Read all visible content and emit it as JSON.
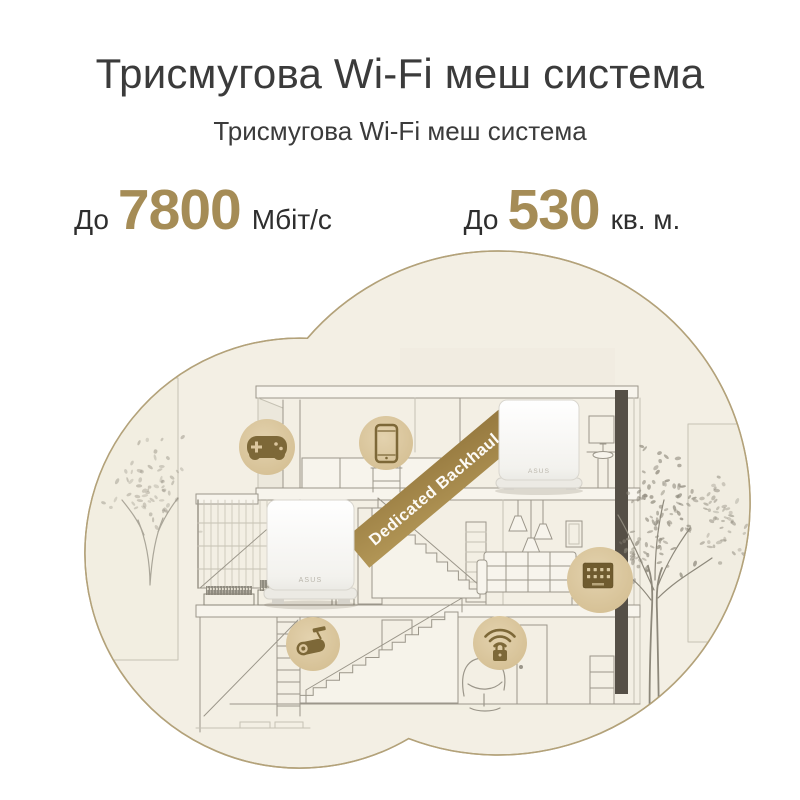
{
  "header": {
    "title": "Трисмугова Wi-Fi меш система",
    "subtitle": "Трисмугова Wi-Fi меш система"
  },
  "specs": [
    {
      "prefix": "До",
      "value": "7800",
      "unit": "Мбіт/с"
    },
    {
      "prefix": "До",
      "value": "530",
      "unit": "кв. м."
    }
  ],
  "diagram": {
    "ribbon_label": "Dedicated Backhaul",
    "router_brand": "ASUS",
    "icons": [
      {
        "name": "gamepad-icon",
        "meaning": "gaming device"
      },
      {
        "name": "smartphone-icon",
        "meaning": "mobile device"
      },
      {
        "name": "security-camera-icon",
        "meaning": "surveillance camera"
      },
      {
        "name": "secured-wifi-icon",
        "meaning": "protected wifi network"
      },
      {
        "name": "smart-panel-icon",
        "meaning": "smart home panel"
      }
    ],
    "colors": {
      "accent_gold": "#a58c56",
      "ribbon": "#a1874f",
      "blob_fill": "#f3efe4",
      "blob_stroke": "#b3a27a",
      "icon_circle": "#dcc79f",
      "icon_glyph": "#7d6838",
      "line_art": "#9b968a",
      "dark_beam": "#554f46"
    }
  }
}
